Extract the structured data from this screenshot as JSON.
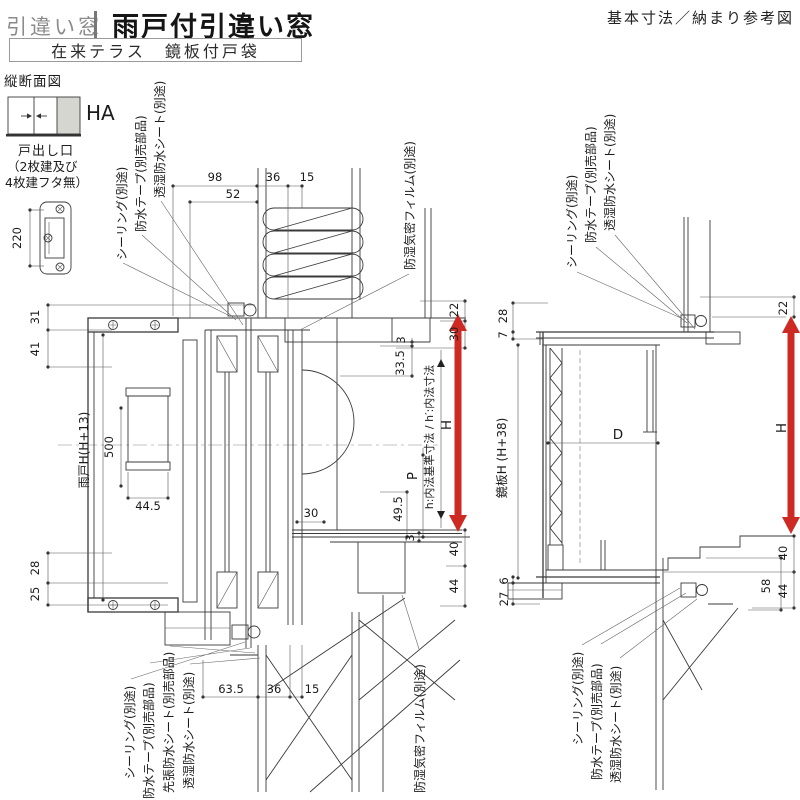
{
  "header": {
    "category": "引違い窓",
    "title": "雨戸付引違い窓",
    "subtitle": "在来テラス　鏡板付戸袋",
    "corner_note": "基本寸法／納まり参考図",
    "section_label": "縦断面図"
  },
  "legend": {
    "code": "HA",
    "caption1": "戸出し口",
    "caption2": "（2枚建及び",
    "caption3": "4枚建フタ無）",
    "handle_dim": "220"
  },
  "left": {
    "dims": {
      "t98": "98",
      "t36": "36",
      "t15": "15",
      "t52": "52",
      "l31": "31",
      "l41": "41",
      "amado_h": "雨戸H(H+13)",
      "v500": "500",
      "w445": "44.5",
      "l28": "28",
      "l25": "25",
      "r22": "22",
      "r30": "30",
      "r3a": "3",
      "r335": "33.5",
      "h": "H",
      "naiho": "h:内法基準寸法 / h′:内法寸法",
      "p": "P",
      "r495": "49.5",
      "m30": "30",
      "r3b": "3",
      "r40": "40",
      "r44": "44",
      "b635": "63.5",
      "b36": "36",
      "b15": "15"
    },
    "notes": {
      "seal_top": "シーリング(別途)",
      "tape_top": "防水テープ(別売部品)",
      "sheet_top": "透湿防水シート(別途)",
      "film_top": "防湿気密フィルム(別途)",
      "seal_bot": "シーリング(別途)",
      "tape_bot": "防水テープ(別売部品)",
      "presheet_bot": "先張防水シート(別売部品)",
      "sheet_bot": "透湿防水シート(別途)",
      "film_bot": "防湿気密フィルム(別途)"
    }
  },
  "right": {
    "dims": {
      "l28": "28",
      "l7": "7",
      "r22": "22",
      "kagami_h": "鏡板H (H+38)",
      "d": "D",
      "h": "H",
      "r40": "40",
      "r58": "58",
      "r44": "44",
      "l6": "6",
      "l27": "27"
    },
    "notes": {
      "seal_top": "シーリング(別途)",
      "tape_top": "防水テープ(別売部品)",
      "sheet_top": "透湿防水シート(別途)",
      "seal_bot": "シーリング(別途)",
      "tape_bot": "防水テープ(別売部品)",
      "sheet_bot": "透湿防水シート(別途)"
    }
  },
  "colors": {
    "accent_red": "#cd2a24",
    "line": "#3a3a3a",
    "gray_fill": "#d6d6d1"
  }
}
